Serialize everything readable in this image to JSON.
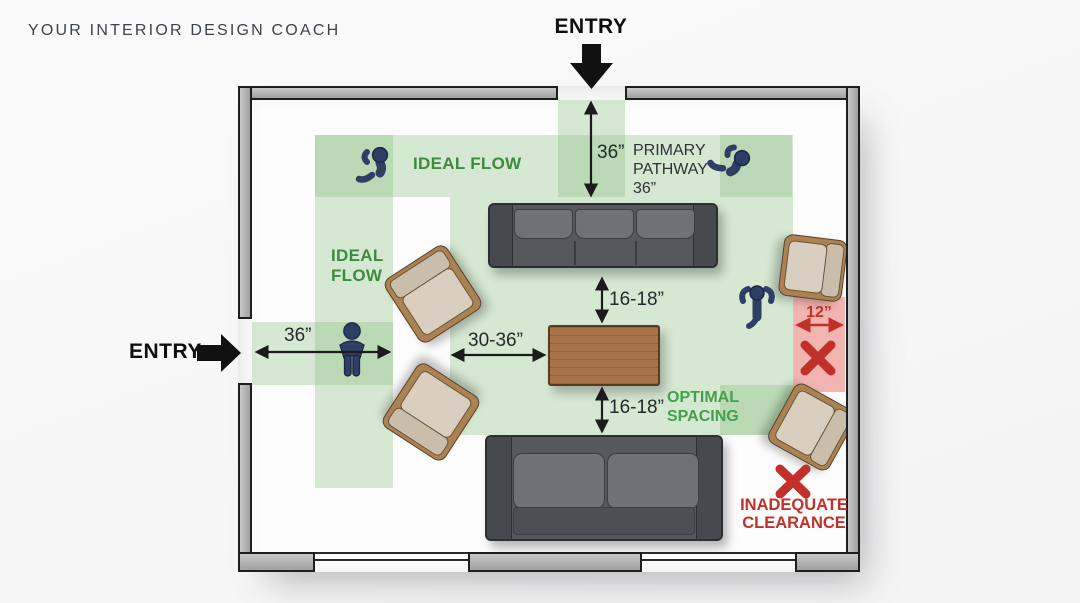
{
  "brand": {
    "title": "YOUR INTERIOR DESIGN COACH"
  },
  "entries": {
    "top": {
      "label": "ENTRY"
    },
    "left": {
      "label": "ENTRY"
    }
  },
  "flow": {
    "ideal_flow_horizontal": "IDEAL FLOW",
    "ideal_flow_vertical": [
      "IDEAL",
      "FLOW"
    ],
    "primary_pathway": [
      "PRIMARY",
      "PATHWAY",
      "36”"
    ]
  },
  "measurements": {
    "top_entry_clearance": "36”",
    "left_entry_clearance": "36”",
    "chair_to_table": "30-36”",
    "sofa_to_table_upper": "16-18”",
    "sofa_to_table_lower": "16-18”",
    "right_wall_gap": "12”"
  },
  "callouts": {
    "optimal": [
      "OPTIMAL",
      "SPACING"
    ],
    "inadequate": [
      "INADEQUATE",
      "CLEARANCE"
    ]
  },
  "icons": {
    "x_mark": "✕",
    "entry_arrow_top": "solid-down-arrow",
    "entry_arrow_left": "solid-right-arrow",
    "people": [
      "walking-person-top-view",
      "walking-person-top-view",
      "standing-person-front-view",
      "person-top-view-arms-out"
    ]
  },
  "colors": {
    "flow_green_text": "#3e8a40",
    "optimal_green_text": "#43a04c",
    "alert_red": "#c23129",
    "flow_zone_green": "rgba(122,186,114,0.30)",
    "inadequate_zone_pink": "#f1b4b1",
    "wall_gray": "#b6b6b6",
    "sofa_gray": "#55585c",
    "chair_tan": "#d9cfc0",
    "table_wood": "#a9734a",
    "person_navy": "#2e3f66"
  }
}
